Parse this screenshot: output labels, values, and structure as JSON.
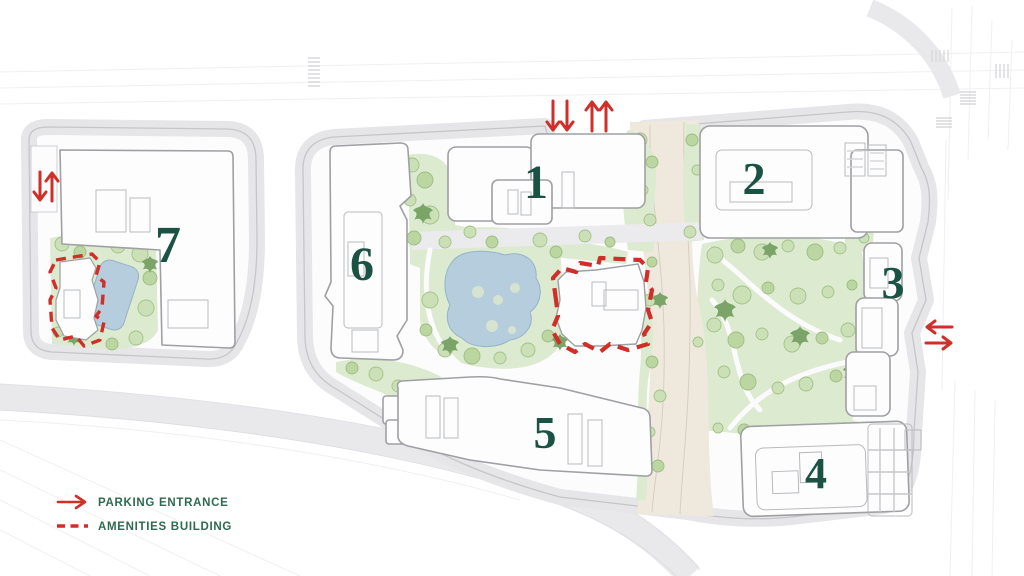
{
  "legend": {
    "items": [
      {
        "symbol": "red-arrow",
        "label": "PARKING ENTRANCE"
      },
      {
        "symbol": "red-dashed-line",
        "label": "AMENITIES BUILDING"
      }
    ]
  },
  "buildings": [
    {
      "number": "1"
    },
    {
      "number": "2"
    },
    {
      "number": "3"
    },
    {
      "number": "4"
    },
    {
      "number": "5"
    },
    {
      "number": "6"
    },
    {
      "number": "7"
    }
  ],
  "parking_entrances": [
    {
      "location": "north-main-parcel",
      "arrow_directions": [
        "down",
        "down",
        "up",
        "up"
      ]
    },
    {
      "location": "east-main-parcel",
      "arrow_directions": [
        "left",
        "right"
      ]
    },
    {
      "location": "west-parcel",
      "arrow_directions": [
        "down",
        "up"
      ]
    }
  ],
  "amenities_buildings": [
    {
      "location": "central-garden-main-parcel"
    },
    {
      "location": "west-parcel-southwest"
    }
  ],
  "colors": {
    "red_accent": "#cf2f28",
    "building_number_green": "#1a5344",
    "legend_text_green": "#2d6a52",
    "landscape_green": "#dcead0",
    "tree_green": "#cbe0b6",
    "palm_green": "#7aa468",
    "water_blue": "#b5cddc",
    "parcel_band_gray": "#e6e6e9",
    "road_tan": "#efe8dc",
    "background": "#ffffff"
  }
}
